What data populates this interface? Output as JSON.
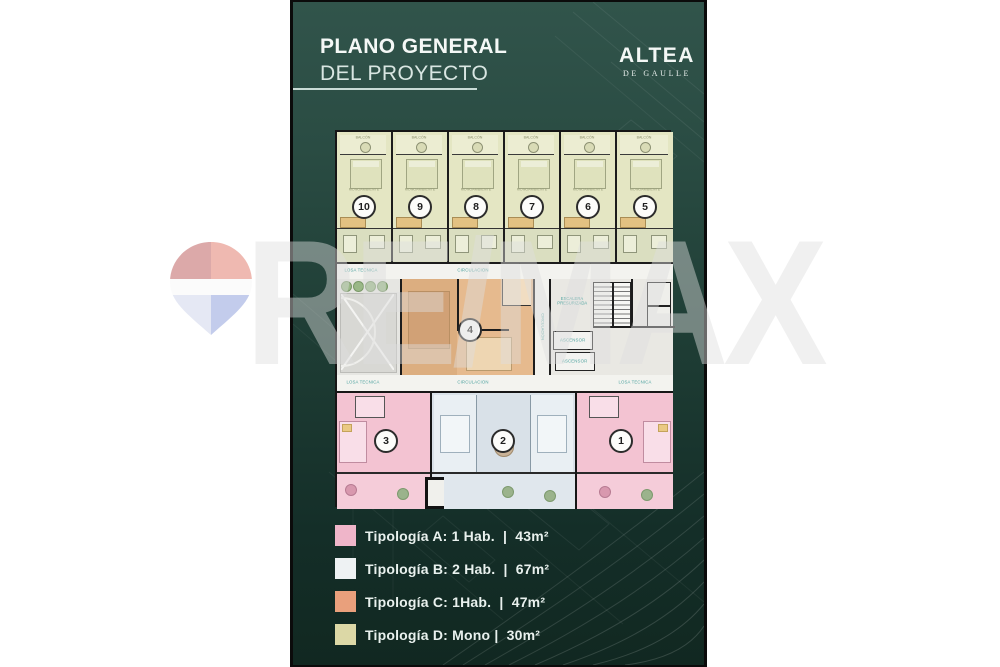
{
  "header": {
    "title_line1": "PLANO GENERAL",
    "title_line2": "DEL PROYECTO",
    "logo_name": "ALTEA",
    "logo_subtitle": "DE GAULLE"
  },
  "watermark": {
    "text": "RE/MAX"
  },
  "floor_plan": {
    "labels": {
      "corridor": "CIRCULACIÓN",
      "service_slab": "LOSA TÉCNICA",
      "stairs_line1": "ESCALERA",
      "stairs_line2": "PRESURIZADA",
      "elevator": "ASCENSOR",
      "studio": "MONOAMBIENTE",
      "balcony": "BALCÓN"
    },
    "top_units": [
      {
        "number": "10",
        "typology": "D"
      },
      {
        "number": "9",
        "typology": "D"
      },
      {
        "number": "8",
        "typology": "D"
      },
      {
        "number": "7",
        "typology": "D"
      },
      {
        "number": "6",
        "typology": "D"
      },
      {
        "number": "5",
        "typology": "D"
      }
    ],
    "middle_unit": {
      "number": "4",
      "typology": "C"
    },
    "bottom_units": [
      {
        "number": "3",
        "typology": "A"
      },
      {
        "number": "2",
        "typology": "B"
      },
      {
        "number": "1",
        "typology": "A"
      }
    ]
  },
  "legend": {
    "items": [
      {
        "label": "Tipología A: 1 Hab.  |  43m²",
        "color": "#efb5c9"
      },
      {
        "label": "Tipología B: 2 Hab.  |  67m²",
        "color": "#eef2f3"
      },
      {
        "label": "Tipología C: 1Hab.  |  47m²",
        "color": "#e9a07c"
      },
      {
        "label": "Tipología D: Mono |  30m²",
        "color": "#dcd8a6"
      }
    ]
  },
  "colors": {
    "card_top": "#2f5148",
    "card_bottom": "#122a24",
    "typology_a": "#efb5c9",
    "typology_b": "#eef2f3",
    "typology_c": "#e9a07c",
    "typology_d": "#dcd8a6",
    "label_teal": "#4fa3a0"
  }
}
